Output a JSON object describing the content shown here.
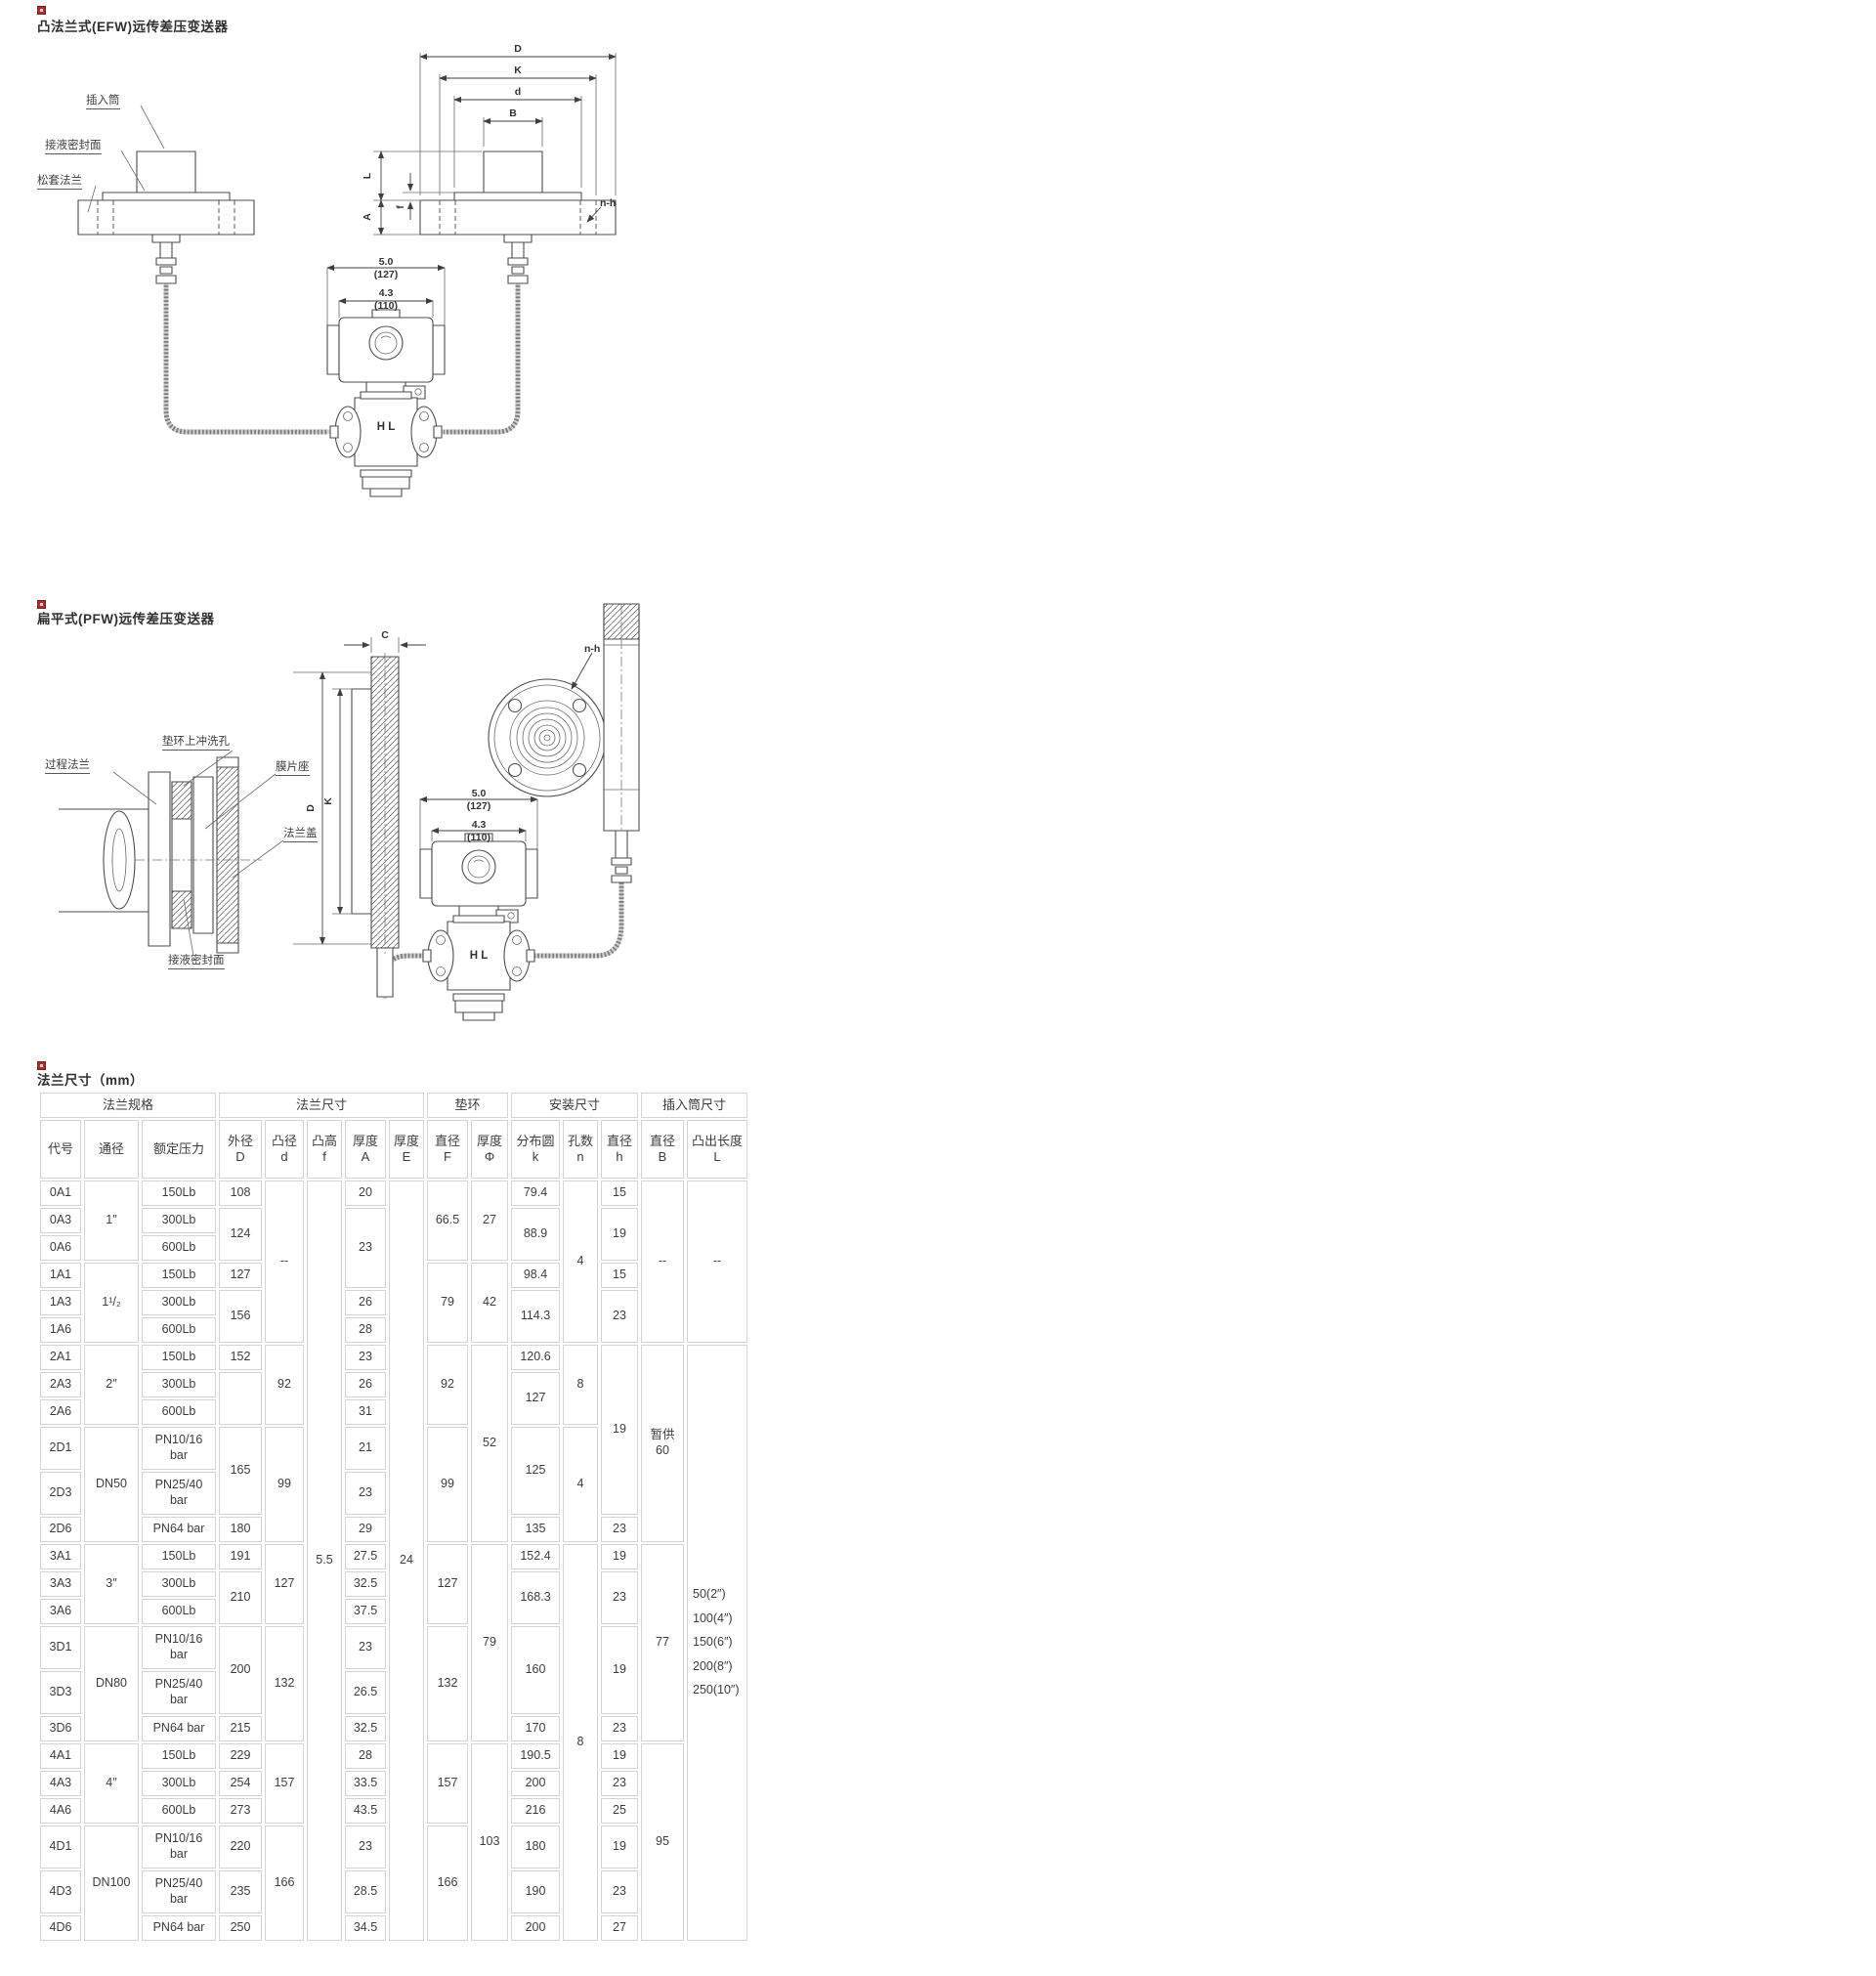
{
  "s1": {
    "title": "凸法兰式(EFW)远传差压变送器",
    "labels": {
      "insert": "插入筒",
      "seal": "接液密封面",
      "flange": "松套法兰",
      "nh": "n-h",
      "hl": "H L"
    },
    "dims": {
      "D": "D",
      "K": "K",
      "d": "d",
      "B": "B",
      "L": "L",
      "A": "A",
      "f": "f",
      "w1": "5.0",
      "w1mm": "(127)",
      "w2": "4.3",
      "w2mm": "(110)"
    }
  },
  "s2": {
    "title": "扁平式(PFW)远传差压变送器",
    "labels": {
      "process": "过程法兰",
      "ring": "垫环上冲洗孔",
      "diaphragm": "膜片座",
      "cover": "法兰盖",
      "seal": "接液密封面",
      "nh": "n-h",
      "hl": "H L"
    },
    "dims": {
      "C": "C",
      "D": "D",
      "K": "K",
      "w1": "5.0",
      "w1mm": "(127)",
      "w2": "4.3",
      "w2mm": "(110)"
    }
  },
  "s3": {
    "title": "法兰尺寸（mm）",
    "table": {
      "groups": [
        {
          "label": "法兰规格",
          "span": 3
        },
        {
          "label": "法兰尺寸",
          "span": 5
        },
        {
          "label": "垫环",
          "span": 2
        },
        {
          "label": "安装尺寸",
          "span": 3
        },
        {
          "label": "插入筒尺寸",
          "span": 2
        }
      ],
      "columns": [
        {
          "l1": "代号"
        },
        {
          "l1": "通径"
        },
        {
          "l1": "额定压力"
        },
        {
          "l1": "外径",
          "l2": "D"
        },
        {
          "l1": "凸径",
          "l2": "d"
        },
        {
          "l1": "凸高",
          "l2": "f"
        },
        {
          "l1": "厚度",
          "l2": "A"
        },
        {
          "l1": "厚度",
          "l2": "E"
        },
        {
          "l1": "直径",
          "l2": "F"
        },
        {
          "l1": "厚度",
          "l2": "Φ"
        },
        {
          "l1": "分布圆",
          "l2": "k"
        },
        {
          "l1": "孔数",
          "l2": "n"
        },
        {
          "l1": "直径",
          "l2": "h"
        },
        {
          "l1": "直径",
          "l2": "B"
        },
        {
          "l1": "凸出长度",
          "l2": "L"
        }
      ],
      "rows": [
        {
          "tall": false,
          "cells": [
            {
              "v": "0A1"
            },
            {
              "v": "1″",
              "r": 3
            },
            {
              "v": "150Lb"
            },
            {
              "v": "108"
            },
            {
              "v": "--",
              "r": 6
            },
            {
              "v": "5.5",
              "r": 24
            },
            {
              "v": "20"
            },
            {
              "v": "24",
              "r": 24
            },
            {
              "v": "66.5",
              "r": 3
            },
            {
              "v": "27",
              "r": 3
            },
            {
              "v": "79.4"
            },
            {
              "v": "4",
              "r": 6
            },
            {
              "v": "15"
            },
            {
              "v": "--",
              "r": 6
            },
            {
              "v": "--",
              "r": 6
            }
          ]
        },
        {
          "tall": false,
          "cells": [
            {
              "v": "0A3"
            },
            {
              "v": "300Lb"
            },
            {
              "v": "124",
              "r": 2
            },
            {
              "v": "23",
              "r": 3
            },
            {
              "v": "88.9",
              "r": 2
            },
            {
              "v": "19",
              "r": 2
            }
          ]
        },
        {
          "tall": false,
          "cells": [
            {
              "v": "0A6"
            },
            {
              "v": "600Lb"
            }
          ]
        },
        {
          "tall": false,
          "cells": [
            {
              "v": "1A1"
            },
            {
              "v": "1¹/₂",
              "r": 3
            },
            {
              "v": "150Lb"
            },
            {
              "v": "127"
            },
            {
              "v": "79",
              "r": 3
            },
            {
              "v": "42",
              "r": 3
            },
            {
              "v": "98.4"
            },
            {
              "v": "15"
            }
          ]
        },
        {
          "tall": false,
          "cells": [
            {
              "v": "1A3"
            },
            {
              "v": "300Lb"
            },
            {
              "v": "156",
              "r": 2
            },
            {
              "v": "26"
            },
            {
              "v": "114.3",
              "r": 2
            },
            {
              "v": "23",
              "r": 2
            }
          ]
        },
        {
          "tall": false,
          "cells": [
            {
              "v": "1A6"
            },
            {
              "v": "600Lb"
            },
            {
              "v": "28"
            }
          ]
        },
        {
          "tall": false,
          "cells": [
            {
              "v": "2A1"
            },
            {
              "v": "2″",
              "r": 3
            },
            {
              "v": "150Lb"
            },
            {
              "v": "152"
            },
            {
              "v": "92",
              "r": 3
            },
            {
              "v": "23"
            },
            {
              "v": "92",
              "r": 3
            },
            {
              "v": "52",
              "r": 6
            },
            {
              "v": "120.6"
            },
            {
              "v": "8",
              "r": 3
            },
            {
              "v": "19",
              "r": 5
            },
            {
              "ls": [
                "暂供",
                "60"
              ],
              "r": 6
            },
            {
              "ls": [
                "50(2″)",
                "100(4″)",
                "150(6″)",
                "200(8″)",
                "250(10″)"
              ],
              "sp": true,
              "r": 18
            }
          ]
        },
        {
          "tall": false,
          "cells": [
            {
              "v": "2A3"
            },
            {
              "v": "300Lb"
            },
            {
              "v": "",
              "r": 2
            },
            {
              "v": "26"
            },
            {
              "v": "127",
              "r": 2
            }
          ]
        },
        {
          "tall": false,
          "cells": [
            {
              "v": "2A6"
            },
            {
              "v": "600Lb"
            },
            {
              "v": "31"
            }
          ]
        },
        {
          "tall": true,
          "cells": [
            {
              "v": "2D1"
            },
            {
              "v": "DN50",
              "r": 3
            },
            {
              "ls": [
                "PN10/16",
                "bar"
              ]
            },
            {
              "v": "165",
              "r": 2
            },
            {
              "v": "99",
              "r": 3
            },
            {
              "v": "21"
            },
            {
              "v": "99",
              "r": 3
            },
            {
              "v": "125",
              "r": 2
            },
            {
              "v": "4",
              "r": 3
            }
          ]
        },
        {
          "tall": true,
          "cells": [
            {
              "v": "2D3"
            },
            {
              "ls": [
                "PN25/40",
                "bar"
              ]
            },
            {
              "v": "23"
            }
          ]
        },
        {
          "tall": false,
          "cells": [
            {
              "v": "2D6"
            },
            {
              "v": "PN64 bar"
            },
            {
              "v": "180"
            },
            {
              "v": "29"
            },
            {
              "v": "135"
            },
            {
              "v": "23"
            }
          ]
        },
        {
          "tall": false,
          "cells": [
            {
              "v": "3A1"
            },
            {
              "v": "3″",
              "r": 3
            },
            {
              "v": "150Lb"
            },
            {
              "v": "191"
            },
            {
              "v": "127",
              "r": 3
            },
            {
              "v": "27.5"
            },
            {
              "v": "127",
              "r": 3
            },
            {
              "v": "79",
              "r": 6
            },
            {
              "v": "152.4"
            },
            {
              "v": "8",
              "r": 12
            },
            {
              "v": "19"
            },
            {
              "v": "77",
              "r": 6
            }
          ]
        },
        {
          "tall": false,
          "cells": [
            {
              "v": "3A3"
            },
            {
              "v": "300Lb"
            },
            {
              "v": "210",
              "r": 2
            },
            {
              "v": "32.5"
            },
            {
              "v": "168.3",
              "r": 2
            },
            {
              "v": "23",
              "r": 2
            }
          ]
        },
        {
          "tall": false,
          "cells": [
            {
              "v": "3A6"
            },
            {
              "v": "600Lb"
            },
            {
              "v": "37.5"
            }
          ]
        },
        {
          "tall": true,
          "cells": [
            {
              "v": "3D1"
            },
            {
              "v": "DN80",
              "r": 3
            },
            {
              "ls": [
                "PN10/16",
                "bar"
              ]
            },
            {
              "v": "200",
              "r": 2
            },
            {
              "v": "132",
              "r": 3
            },
            {
              "v": "23"
            },
            {
              "v": "132",
              "r": 3
            },
            {
              "v": "160",
              "r": 2
            },
            {
              "v": "19",
              "r": 2
            }
          ]
        },
        {
          "tall": true,
          "cells": [
            {
              "v": "3D3"
            },
            {
              "ls": [
                "PN25/40",
                "bar"
              ]
            },
            {
              "v": "26.5"
            }
          ]
        },
        {
          "tall": false,
          "cells": [
            {
              "v": "3D6"
            },
            {
              "v": "PN64 bar"
            },
            {
              "v": "215"
            },
            {
              "v": "32.5"
            },
            {
              "v": "170"
            },
            {
              "v": "23"
            }
          ]
        },
        {
          "tall": false,
          "cells": [
            {
              "v": "4A1"
            },
            {
              "v": "4″",
              "r": 3
            },
            {
              "v": "150Lb"
            },
            {
              "v": "229"
            },
            {
              "v": "157",
              "r": 3
            },
            {
              "v": "28"
            },
            {
              "v": "157",
              "r": 3
            },
            {
              "v": "103",
              "r": 6
            },
            {
              "v": "190.5"
            },
            {
              "v": "19"
            },
            {
              "v": "95",
              "r": 6
            }
          ]
        },
        {
          "tall": false,
          "cells": [
            {
              "v": "4A3"
            },
            {
              "v": "300Lb"
            },
            {
              "v": "254"
            },
            {
              "v": "33.5"
            },
            {
              "v": "200"
            },
            {
              "v": "23"
            }
          ]
        },
        {
          "tall": false,
          "cells": [
            {
              "v": "4A6"
            },
            {
              "v": "600Lb"
            },
            {
              "v": "273"
            },
            {
              "v": "43.5"
            },
            {
              "v": "216"
            },
            {
              "v": "25"
            }
          ]
        },
        {
          "tall": true,
          "cells": [
            {
              "v": "4D1"
            },
            {
              "v": "DN100",
              "r": 3
            },
            {
              "ls": [
                "PN10/16",
                "bar"
              ]
            },
            {
              "v": "220"
            },
            {
              "v": "166",
              "r": 3
            },
            {
              "v": "23"
            },
            {
              "v": "166",
              "r": 3
            },
            {
              "v": "180"
            },
            {
              "v": "19"
            }
          ]
        },
        {
          "tall": true,
          "cells": [
            {
              "v": "4D3"
            },
            {
              "ls": [
                "PN25/40",
                "bar"
              ]
            },
            {
              "v": "235"
            },
            {
              "v": "28.5"
            },
            {
              "v": "190"
            },
            {
              "v": "23"
            }
          ]
        },
        {
          "tall": false,
          "cells": [
            {
              "v": "4D6"
            },
            {
              "v": "PN64 bar"
            },
            {
              "v": "250"
            },
            {
              "v": "34.5"
            },
            {
              "v": "200"
            },
            {
              "v": "27"
            }
          ]
        }
      ]
    }
  }
}
